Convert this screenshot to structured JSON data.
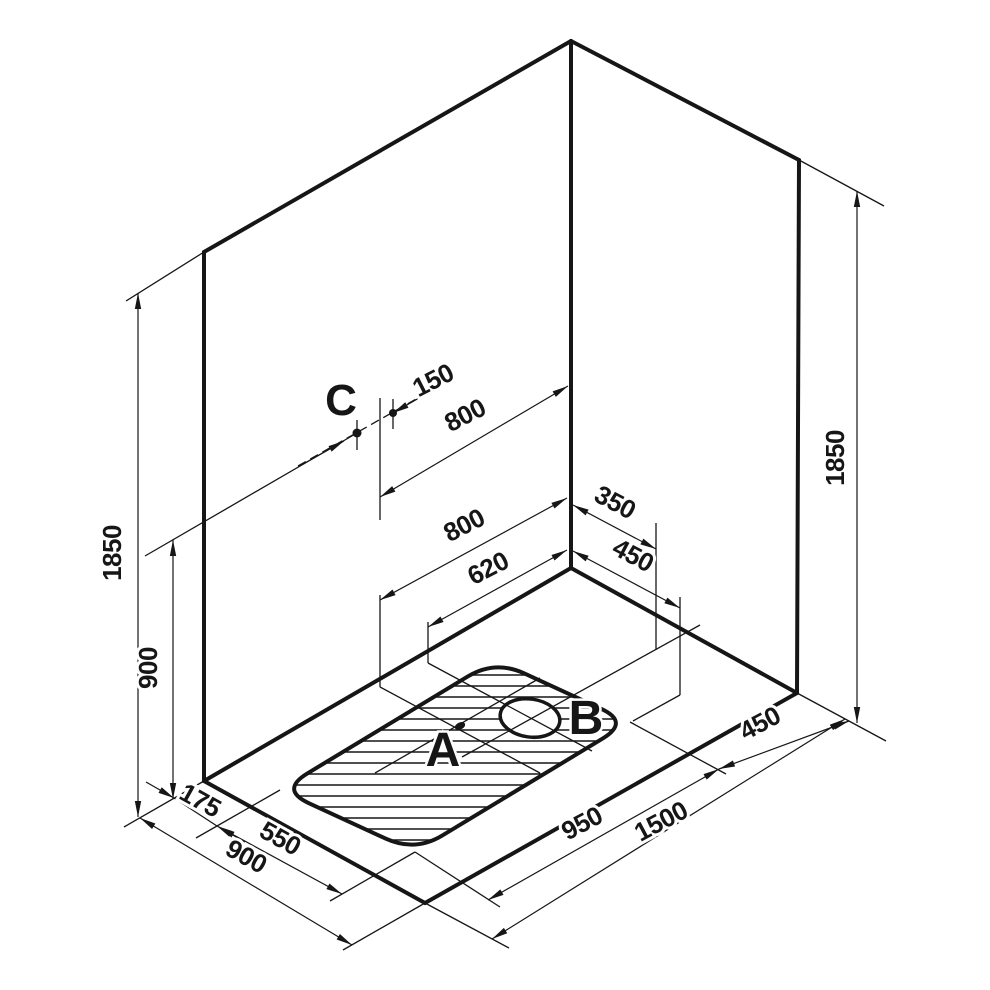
{
  "drawing": {
    "description": "Isometric installation drawing of a corner shower area, dimensions in mm",
    "points": {
      "a": "A",
      "b": "B",
      "c": "C"
    },
    "dims": {
      "wall_height_left": "1850",
      "wall_height_right": "1850",
      "c_height": "900",
      "c_offset": "150",
      "c_from_corner": "800",
      "a_from_corner": "800",
      "b_from_corner": "620",
      "b_right_offset": "350",
      "tray_right_offset": "450",
      "floor_margin_left": "175",
      "tray_width": "550",
      "floor_depth": "900",
      "tray_length": "950",
      "floor_width": "1500",
      "tray_margin_right": "450"
    },
    "colors": {
      "line": "#161616",
      "background": "#ffffff"
    }
  }
}
